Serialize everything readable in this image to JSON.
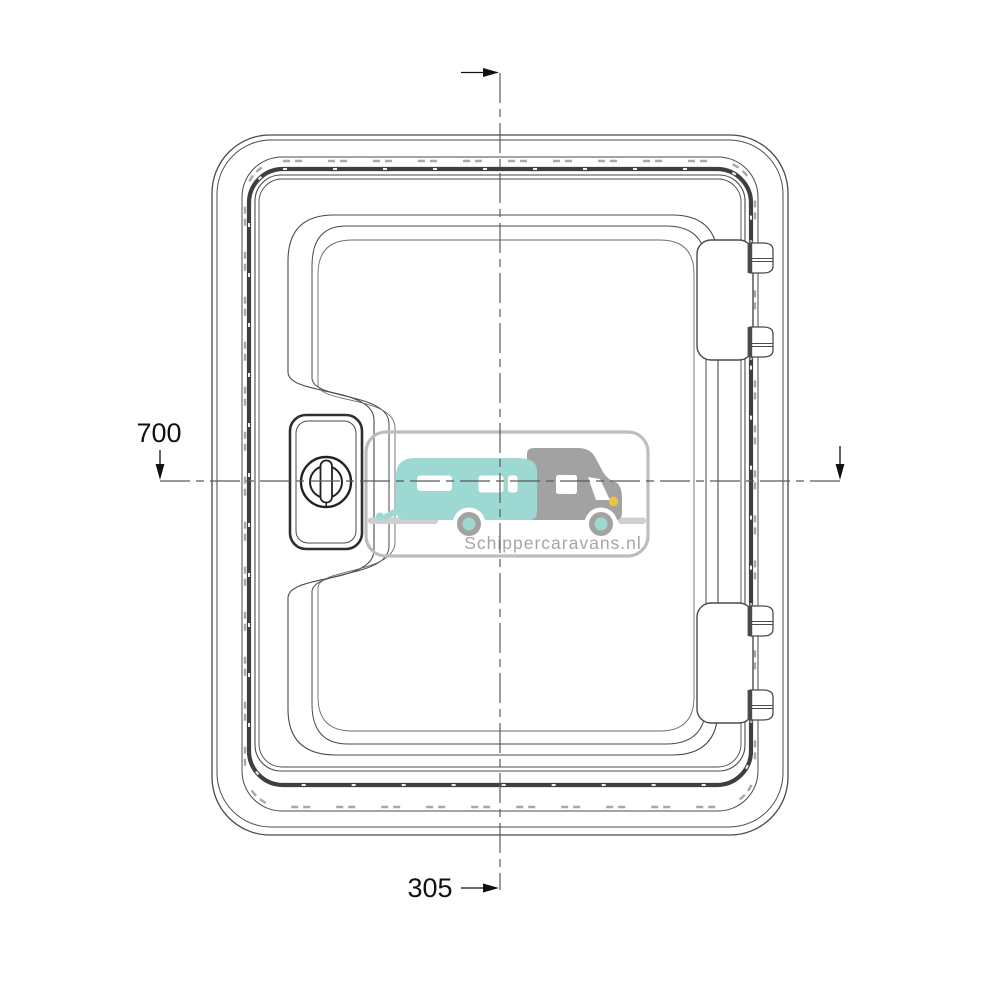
{
  "page": {
    "description": "Technical line drawing of a caravan service door / hatch with lock and hinges",
    "background": "#ffffff"
  },
  "dimensions": {
    "height_label": "700",
    "width_label": "305"
  },
  "watermark": {
    "text": "Schippercaravans.nl",
    "caravan_icon": "caravan-trailer",
    "motorhome_icon": "motorhome-van"
  },
  "colors": {
    "line": "#4a4a4a",
    "lineLight": "#6a6a6a",
    "band": "#3f3f3f",
    "hatch": "#a8a8a8",
    "pin": "#b0b0b0",
    "pindark": "#4a4a4a",
    "dim": "#111111",
    "centerline": "#5a5a5a",
    "wmborder": "#bdbdbd",
    "wmteal": "#9ed8d2",
    "wmgray": "#a2a2a2",
    "wmtext": "#a6a6a6",
    "wmyellow": "#e6c63f",
    "wmground": "#cfcfcf",
    "white": "#ffffff"
  }
}
